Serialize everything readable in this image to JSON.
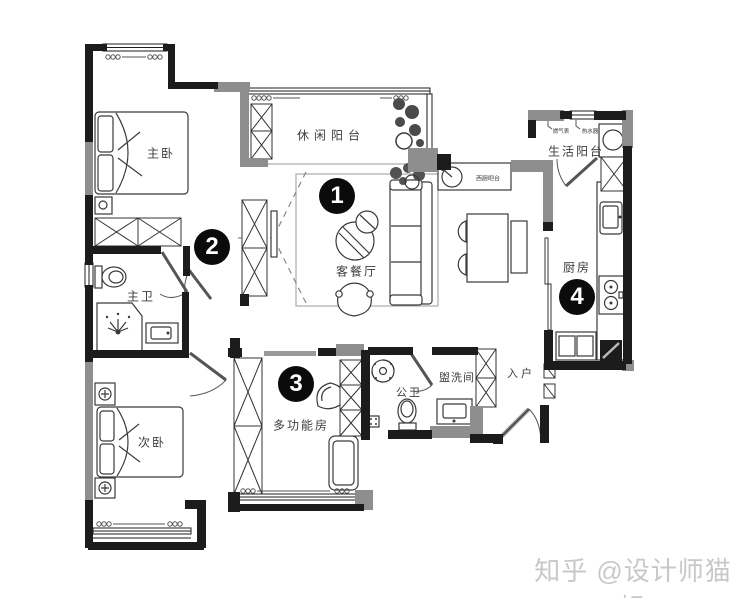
{
  "labels": {
    "master_bedroom": "主卧",
    "leisure_balcony": "休闲阳台",
    "life_balcony": "生活阳台",
    "living_dining": "客餐厅",
    "kitchen": "厨房",
    "master_bath": "主卫",
    "second_bedroom": "次卧",
    "multi_function_room": "多功能房",
    "public_bath": "公卫",
    "washroom": "盥洗间",
    "entry": "入户",
    "west_kitchen_bar": "西厨吧台",
    "gas_meter": "燃气表",
    "water_heater": "热水器"
  },
  "markers": {
    "m1": "1",
    "m2": "2",
    "m3": "3",
    "m4": "4"
  },
  "watermark": {
    "text": "知乎 @设计师猫姐"
  },
  "colors": {
    "wall_black": "#1c1c1c",
    "wall_gray": "#8e8e8e",
    "furniture_line": "#3a3a3a",
    "label_text": "#3d3d3d",
    "marker_bg": "#0b0b0b",
    "marker_fg": "#ffffff",
    "watermark": "#c8c8c8"
  }
}
